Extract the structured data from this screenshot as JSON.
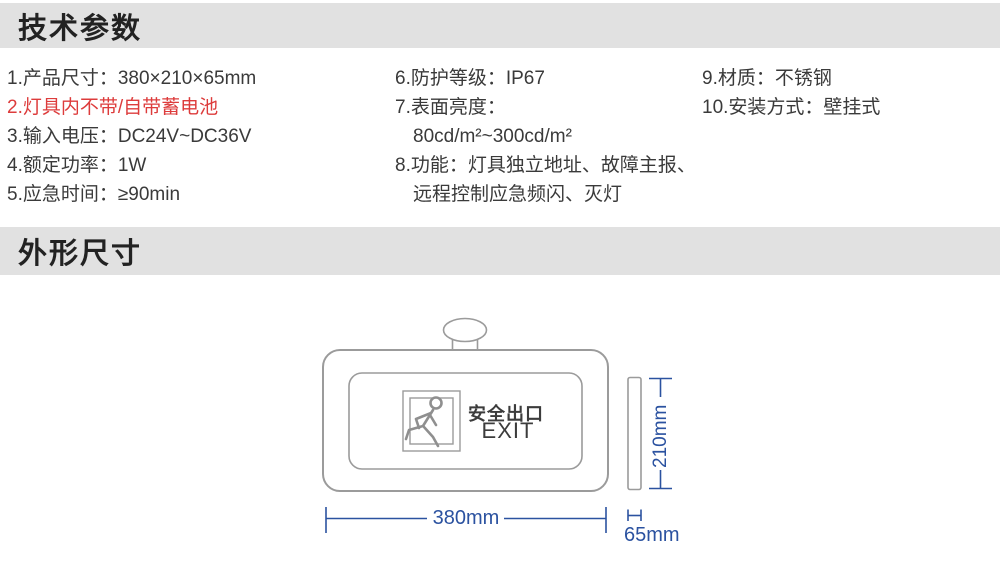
{
  "colors": {
    "section_bar_bg": "#e1e1e1",
    "heading_text": "#222222",
    "body_text": "#3a3a3a",
    "alert_red": "#dd3c3c",
    "drawing_line_gray": "#9b9b9b",
    "dimension_blue": "#2b52a0"
  },
  "tech_params": {
    "title": "技术参数",
    "col1": [
      "1.产品尺寸：380×210×65mm",
      "2.灯具内不带/自带蓄电池",
      "3.输入电压：DC24V~DC36V",
      "4.额定功率：1W",
      "5.应急时间：≥90min"
    ],
    "col2": [
      "6.防护等级：IP67",
      "7.表面亮度：",
      "80cd/m²~300cd/m²",
      "8.功能：灯具独立地址、故障主报、",
      "远程控制应急频闪、灭灯"
    ],
    "col3": [
      "9.材质：不锈钢",
      "10.安装方式：壁挂式"
    ]
  },
  "outline": {
    "title": "外形尺寸",
    "sign_text_cn": "安全出口",
    "sign_text_en": "EXIT",
    "dim_width": "380mm",
    "dim_height": "210mm",
    "dim_depth": "65mm"
  }
}
